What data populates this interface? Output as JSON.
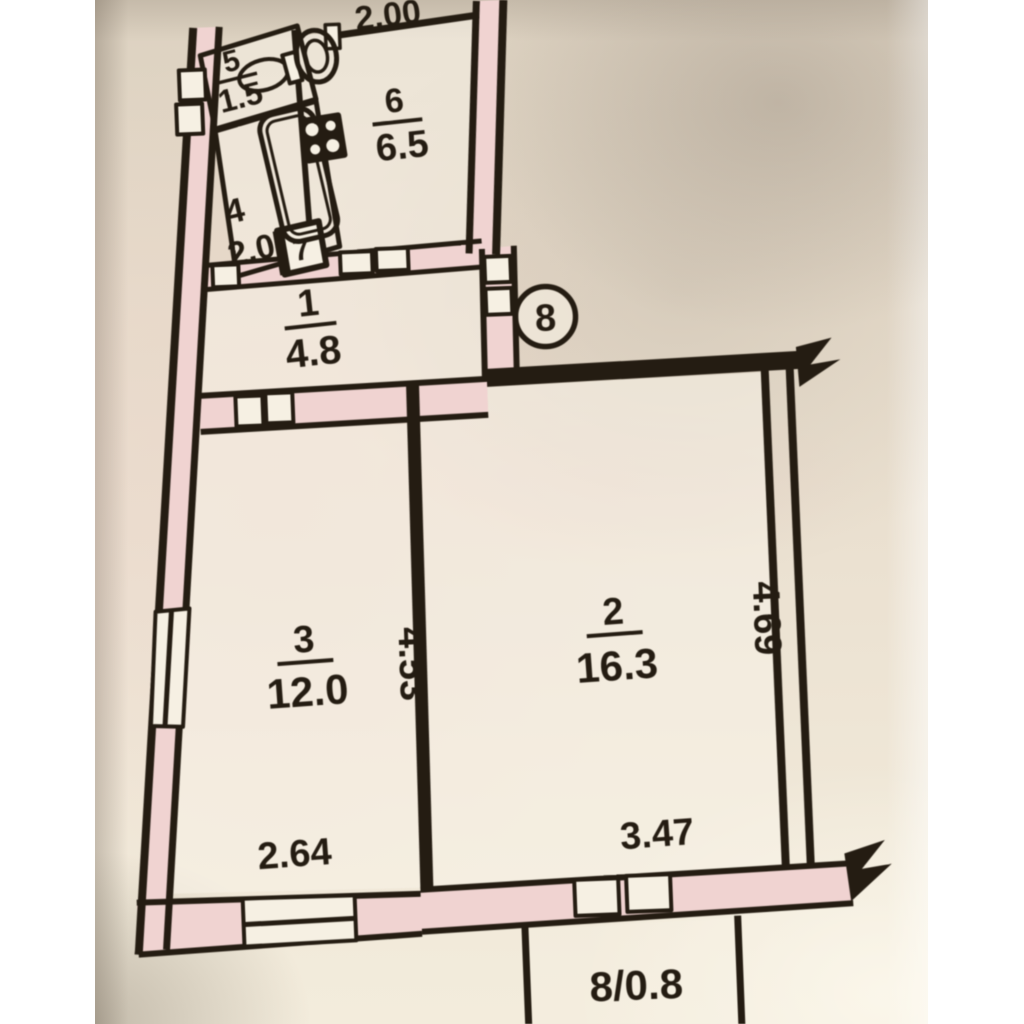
{
  "photo": {
    "plan": {
      "rooms": [
        {
          "number": "5",
          "area": "1.5"
        },
        {
          "number": "4",
          "area": "2.0."
        },
        {
          "number": "6",
          "area": "6.5"
        },
        {
          "number": "7"
        },
        {
          "number": "1",
          "area": "4.8"
        },
        {
          "number": "3",
          "area": "12.0"
        },
        {
          "number": "2",
          "area": "16.3"
        }
      ],
      "marker_circle": "8",
      "balcony_label": "8/0.8",
      "dimensions": {
        "kitchen_width": "2.00",
        "room3_width": "2.64",
        "room3_depth": "4.53",
        "room2_width": "3.47",
        "room2_depth": "4.69"
      },
      "colors": {
        "ink": "#241c12",
        "wall_fill": "#f0d3d1",
        "paper": "#e9dfd0",
        "cutout": "#f6f0e3"
      }
    }
  }
}
